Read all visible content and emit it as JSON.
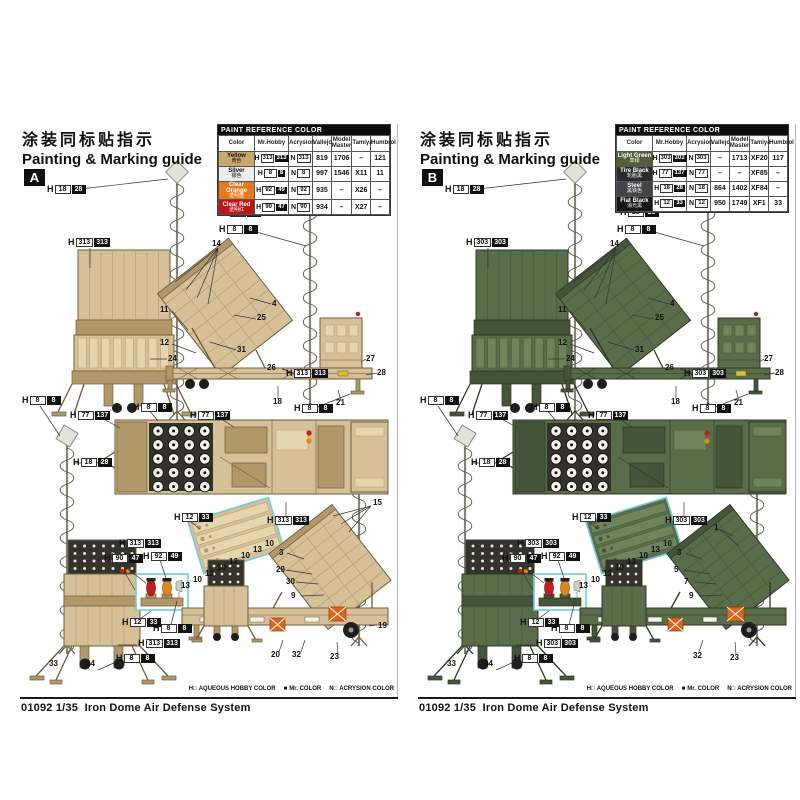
{
  "sheet": {
    "product_code": "01092",
    "product_scale": "1/35",
    "product_name": "Iron Dome Air Defense System",
    "legend": [
      {
        "key": "H□",
        "label": "AQUEOUS HOBBY COLOR"
      },
      {
        "key": "■",
        "label": "Mr. COLOR"
      },
      {
        "key": "N□",
        "label": "ACRYSION COLOR"
      }
    ]
  },
  "panels": [
    {
      "letter": "A",
      "title_cn": "涂装同标贴指示",
      "title_en": "Painting & Marking guide",
      "scheme": {
        "body": "#d6c097",
        "mid": "#e6d6ae",
        "dark": "#b2976a",
        "outline": "#6d5c3a"
      },
      "table": {
        "header": "PAINT REFERENCE COLOR",
        "columns": [
          "Color",
          "Mr.Hobby",
          "Acrysion",
          "Vallejo",
          "Model Master",
          "Tamiya",
          "Humbrol"
        ],
        "rows": [
          {
            "name": "Yellow",
            "name_cn": "黄色",
            "swatch": "#c9a66b",
            "ink": "#111111",
            "aqueous": "313",
            "mr_color": "313",
            "acrysion": "313",
            "vallejo": "819",
            "model_master": "1706",
            "tamiya": "–",
            "humbrol": "121"
          },
          {
            "name": "Silver",
            "name_cn": "银色",
            "swatch": "#ececea",
            "ink": "#111111",
            "aqueous": "8",
            "mr_color": "8",
            "acrysion": "8",
            "vallejo": "997",
            "model_master": "1546",
            "tamiya": "X11",
            "humbrol": "11"
          },
          {
            "name": "Clear Orange",
            "name_cn": "透明橙",
            "swatch": "#e8781c",
            "ink": "#ffffff",
            "aqueous": "92",
            "mr_color": "49",
            "acrysion": "92",
            "vallejo": "935",
            "model_master": "–",
            "tamiya": "X26",
            "humbrol": "–"
          },
          {
            "name": "Clear Red",
            "name_cn": "透明红",
            "swatch": "#bb1717",
            "ink": "#ffffff",
            "aqueous": "90",
            "mr_color": "47",
            "acrysion": "90",
            "vallejo": "934",
            "model_master": "–",
            "tamiya": "X27",
            "humbrol": "–"
          }
        ]
      },
      "callouts": [
        {
          "t": "p",
          "a": "18",
          "m": "28",
          "x": 27,
          "y": 62
        },
        {
          "t": "p",
          "a": "18",
          "m": "28",
          "x": 202,
          "y": 85
        },
        {
          "t": "p",
          "a": "8",
          "m": "8",
          "x": 199,
          "y": 102
        },
        {
          "t": "p",
          "a": "313",
          "m": "313",
          "x": 48,
          "y": 115
        },
        {
          "t": "n",
          "v": "14",
          "x": 192,
          "y": 117
        },
        {
          "t": "n",
          "v": "4",
          "x": 252,
          "y": 177
        },
        {
          "t": "n",
          "v": "25",
          "x": 237,
          "y": 191
        },
        {
          "t": "n",
          "v": "11",
          "x": 140,
          "y": 183
        },
        {
          "t": "n",
          "v": "12",
          "x": 140,
          "y": 216
        },
        {
          "t": "n",
          "v": "24",
          "x": 148,
          "y": 232
        },
        {
          "t": "n",
          "v": "31",
          "x": 217,
          "y": 223
        },
        {
          "t": "p",
          "a": "313",
          "m": "313",
          "x": 266,
          "y": 246
        },
        {
          "t": "n",
          "v": "27",
          "x": 346,
          "y": 232
        },
        {
          "t": "n",
          "v": "28",
          "x": 357,
          "y": 246
        },
        {
          "t": "n",
          "v": "26",
          "x": 247,
          "y": 241
        },
        {
          "t": "n",
          "v": "18",
          "x": 253,
          "y": 275
        },
        {
          "t": "n",
          "v": "21",
          "x": 316,
          "y": 276
        },
        {
          "t": "p",
          "a": "8",
          "m": "8",
          "x": 274,
          "y": 281
        },
        {
          "t": "p",
          "a": "8",
          "m": "8",
          "x": 2,
          "y": 273
        },
        {
          "t": "p",
          "a": "77",
          "m": "137",
          "x": 50,
          "y": 288
        },
        {
          "t": "p",
          "a": "8",
          "m": "8",
          "x": 113,
          "y": 280
        },
        {
          "t": "p",
          "a": "77",
          "m": "137",
          "x": 170,
          "y": 288
        },
        {
          "t": "p",
          "a": "18",
          "m": "28",
          "x": 53,
          "y": 335
        },
        {
          "t": "p",
          "a": "12",
          "m": "33",
          "x": 154,
          "y": 390
        },
        {
          "t": "p",
          "a": "313",
          "m": "313",
          "x": 247,
          "y": 393
        },
        {
          "t": "n",
          "v": "15",
          "x": 353,
          "y": 376
        },
        {
          "t": "p",
          "a": "313",
          "m": "313",
          "x": 99,
          "y": 416
        },
        {
          "t": "p",
          "a": "90",
          "m": "47",
          "x": 84,
          "y": 431
        },
        {
          "t": "p",
          "a": "92",
          "m": "49",
          "x": 123,
          "y": 429
        },
        {
          "t": "p",
          "a": "12",
          "m": "33",
          "x": 102,
          "y": 495
        },
        {
          "t": "p",
          "a": "8",
          "m": "8",
          "x": 133,
          "y": 501
        },
        {
          "t": "p",
          "a": "313",
          "m": "313",
          "x": 118,
          "y": 516
        },
        {
          "t": "p",
          "a": "8",
          "m": "8",
          "x": 96,
          "y": 531
        },
        {
          "t": "n",
          "v": "33",
          "x": 29,
          "y": 537
        },
        {
          "t": "n",
          "v": "34",
          "x": 66,
          "y": 537
        },
        {
          "t": "n",
          "v": "3",
          "x": 259,
          "y": 426
        },
        {
          "t": "n",
          "v": "29",
          "x": 256,
          "y": 443
        },
        {
          "t": "n",
          "v": "30",
          "x": 266,
          "y": 455
        },
        {
          "t": "n",
          "v": "9",
          "x": 271,
          "y": 469
        },
        {
          "t": "n",
          "v": "19",
          "x": 358,
          "y": 499
        },
        {
          "t": "n",
          "v": "20",
          "x": 251,
          "y": 528
        },
        {
          "t": "n",
          "v": "32",
          "x": 272,
          "y": 528
        },
        {
          "t": "n",
          "v": "23",
          "x": 310,
          "y": 530
        },
        {
          "t": "n",
          "v": "10",
          "x": 245,
          "y": 417
        },
        {
          "t": "n",
          "v": "13",
          "x": 233,
          "y": 423
        },
        {
          "t": "n",
          "v": "10",
          "x": 221,
          "y": 429
        },
        {
          "t": "n",
          "v": "13",
          "x": 209,
          "y": 435
        },
        {
          "t": "n",
          "v": "10",
          "x": 197,
          "y": 441
        },
        {
          "t": "n",
          "v": "13",
          "x": 185,
          "y": 447
        },
        {
          "t": "n",
          "v": "10",
          "x": 173,
          "y": 453
        },
        {
          "t": "n",
          "v": "13",
          "x": 161,
          "y": 459
        }
      ]
    },
    {
      "letter": "B",
      "title_cn": "涂装同标贴指示",
      "title_en": "Painting & Marking guide",
      "scheme": {
        "body": "#5a6d4a",
        "mid": "#70845c",
        "dark": "#45553a",
        "outline": "#2c3822"
      },
      "table": {
        "header": "PAINT REFERENCE COLOR",
        "columns": [
          "Color",
          "Mr.Hobby",
          "Acrysion",
          "Vallejo",
          "Model Master",
          "Tamiya",
          "Humbrol"
        ],
        "rows": [
          {
            "name": "Light Green",
            "name_cn": "草绿",
            "swatch": "#4e6137",
            "ink": "#ffffff",
            "aqueous": "303",
            "mr_color": "303",
            "acrysion": "303",
            "vallejo": "–",
            "model_master": "1713",
            "tamiya": "XF20",
            "humbrol": "117"
          },
          {
            "name": "Tire Black",
            "name_cn": "轮胎黑",
            "swatch": "#2b2b2b",
            "ink": "#ffffff",
            "aqueous": "77",
            "mr_color": "137",
            "acrysion": "77",
            "vallejo": "–",
            "model_master": "–",
            "tamiya": "XF85",
            "humbrol": "–"
          },
          {
            "name": "Steel",
            "name_cn": "黑铁色",
            "swatch": "#43434b",
            "ink": "#ffffff",
            "aqueous": "18",
            "mr_color": "28",
            "acrysion": "18",
            "vallejo": "864",
            "model_master": "1402",
            "tamiya": "XF84",
            "humbrol": "–"
          },
          {
            "name": "Flat Black",
            "name_cn": "消光黑",
            "swatch": "#161616",
            "ink": "#ffffff",
            "aqueous": "12",
            "mr_color": "33",
            "acrysion": "12",
            "vallejo": "950",
            "model_master": "1749",
            "tamiya": "XF1",
            "humbrol": "33"
          }
        ]
      },
      "callouts": [
        {
          "t": "p",
          "a": "18",
          "m": "28",
          "x": 27,
          "y": 62
        },
        {
          "t": "p",
          "a": "18",
          "m": "28",
          "x": 202,
          "y": 85
        },
        {
          "t": "p",
          "a": "8",
          "m": "8",
          "x": 199,
          "y": 102
        },
        {
          "t": "p",
          "a": "303",
          "m": "303",
          "x": 48,
          "y": 115
        },
        {
          "t": "n",
          "v": "14",
          "x": 192,
          "y": 117
        },
        {
          "t": "n",
          "v": "4",
          "x": 252,
          "y": 177
        },
        {
          "t": "n",
          "v": "25",
          "x": 237,
          "y": 191
        },
        {
          "t": "n",
          "v": "11",
          "x": 140,
          "y": 183
        },
        {
          "t": "n",
          "v": "12",
          "x": 140,
          "y": 216
        },
        {
          "t": "n",
          "v": "24",
          "x": 148,
          "y": 232
        },
        {
          "t": "n",
          "v": "31",
          "x": 217,
          "y": 223
        },
        {
          "t": "p",
          "a": "303",
          "m": "303",
          "x": 266,
          "y": 246
        },
        {
          "t": "n",
          "v": "27",
          "x": 346,
          "y": 232
        },
        {
          "t": "n",
          "v": "28",
          "x": 357,
          "y": 246
        },
        {
          "t": "n",
          "v": "26",
          "x": 247,
          "y": 241
        },
        {
          "t": "n",
          "v": "18",
          "x": 253,
          "y": 275
        },
        {
          "t": "n",
          "v": "21",
          "x": 316,
          "y": 276
        },
        {
          "t": "p",
          "a": "8",
          "m": "8",
          "x": 274,
          "y": 281
        },
        {
          "t": "p",
          "a": "8",
          "m": "8",
          "x": 2,
          "y": 273
        },
        {
          "t": "p",
          "a": "77",
          "m": "137",
          "x": 50,
          "y": 288
        },
        {
          "t": "p",
          "a": "8",
          "m": "8",
          "x": 113,
          "y": 280
        },
        {
          "t": "p",
          "a": "77",
          "m": "137",
          "x": 170,
          "y": 288
        },
        {
          "t": "p",
          "a": "18",
          "m": "28",
          "x": 53,
          "y": 335
        },
        {
          "t": "p",
          "a": "12",
          "m": "33",
          "x": 154,
          "y": 390
        },
        {
          "t": "p",
          "a": "303",
          "m": "303",
          "x": 247,
          "y": 393
        },
        {
          "t": "n",
          "v": "1",
          "x": 296,
          "y": 401
        },
        {
          "t": "p",
          "a": "303",
          "m": "303",
          "x": 99,
          "y": 416
        },
        {
          "t": "p",
          "a": "90",
          "m": "47",
          "x": 84,
          "y": 431
        },
        {
          "t": "p",
          "a": "92",
          "m": "49",
          "x": 123,
          "y": 429
        },
        {
          "t": "p",
          "a": "12",
          "m": "33",
          "x": 102,
          "y": 495
        },
        {
          "t": "p",
          "a": "8",
          "m": "8",
          "x": 133,
          "y": 501
        },
        {
          "t": "p",
          "a": "303",
          "m": "303",
          "x": 118,
          "y": 516
        },
        {
          "t": "p",
          "a": "8",
          "m": "8",
          "x": 96,
          "y": 531
        },
        {
          "t": "n",
          "v": "33",
          "x": 29,
          "y": 537
        },
        {
          "t": "n",
          "v": "34",
          "x": 66,
          "y": 537
        },
        {
          "t": "n",
          "v": "3",
          "x": 259,
          "y": 426
        },
        {
          "t": "n",
          "v": "5",
          "x": 256,
          "y": 443
        },
        {
          "t": "n",
          "v": "7",
          "x": 266,
          "y": 455
        },
        {
          "t": "n",
          "v": "9",
          "x": 271,
          "y": 469
        },
        {
          "t": "n",
          "v": "32",
          "x": 275,
          "y": 529
        },
        {
          "t": "n",
          "v": "23",
          "x": 312,
          "y": 531
        },
        {
          "t": "n",
          "v": "10",
          "x": 245,
          "y": 417
        },
        {
          "t": "n",
          "v": "13",
          "x": 233,
          "y": 423
        },
        {
          "t": "n",
          "v": "10",
          "x": 221,
          "y": 429
        },
        {
          "t": "n",
          "v": "13",
          "x": 209,
          "y": 435
        },
        {
          "t": "n",
          "v": "10",
          "x": 197,
          "y": 441
        },
        {
          "t": "n",
          "v": "13",
          "x": 185,
          "y": 447
        },
        {
          "t": "n",
          "v": "10",
          "x": 173,
          "y": 453
        },
        {
          "t": "n",
          "v": "13",
          "x": 161,
          "y": 459
        }
      ]
    }
  ]
}
